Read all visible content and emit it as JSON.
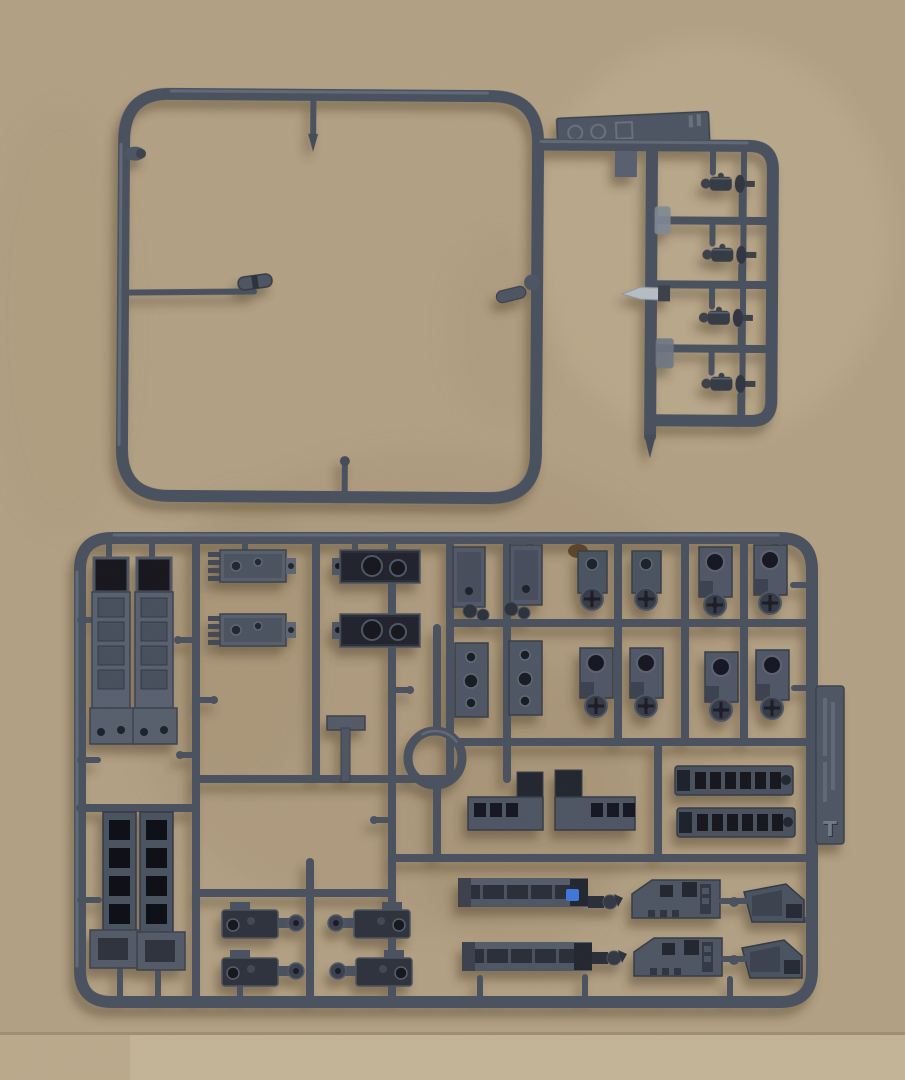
{
  "photo": {
    "description": "Top-down photograph of two dark gunmetal-gray injection-molded plastic model kit sprues (part runners) lying on a tan cardboard sheet with water stains and a lighter seam strip along the bottom edge."
  },
  "colors": {
    "cardboard": "#b3a185",
    "cardboard_light_strip": "#c4b496",
    "cardboard_stain": "#9b886a",
    "plastic_runner": "#49515f",
    "plastic_highlight": "#68727f",
    "plastic_dark": "#2a2e38",
    "plastic_recess": "#14171d",
    "bare_metal_blade": "#b6bdc5",
    "blue_paint_spot": "#3f76db",
    "scuff_brown": "#54391f"
  },
  "top_sprue": {
    "name": "square frame runner",
    "description": "Large empty rounded-square runner frame with a small ladder section on the right holding four tiny detail parts and one bayonet-blade part",
    "tag": {
      "marks": [
        "recycle-circle-symbol",
        "recycle-circle-symbol",
        "material-square-symbol",
        "mold-tick-marks"
      ]
    },
    "parts": [
      {
        "name": "tiny figure fitting part",
        "count": 4
      },
      {
        "name": "bayonet blade part",
        "count": 1
      },
      {
        "name": "clip part on inner rod",
        "count": 1
      },
      {
        "name": "clip part on right edge",
        "count": 1
      }
    ]
  },
  "bottom_sprue": {
    "name": "rectangular parts runner",
    "description": "Densely packed runner with hull, chassis and running-gear parts for a military vehicle model kit",
    "tag_letter": "T",
    "embossed_text_note": "illegible embossed lettering on side tag above the letter T",
    "parts": [
      {
        "name": "hull side channel",
        "count": 2
      },
      {
        "name": "ribbed deck plate",
        "count": 2
      },
      {
        "name": "dark twin-hole plate",
        "count": 2
      },
      {
        "name": "small vertical plate",
        "count": 2
      },
      {
        "name": "multi-hole side plate",
        "count": 2
      },
      {
        "name": "axle mount with sprocket wheel",
        "count": 8
      },
      {
        "name": "T-shaped bracket",
        "count": 1
      },
      {
        "name": "ring race part",
        "count": 1
      },
      {
        "name": "stepped window bracket mirrored pair",
        "count": 2
      },
      {
        "name": "slotted roof bar",
        "count": 2
      },
      {
        "name": "track ladder section",
        "count": 2
      },
      {
        "name": "gearbox housing",
        "count": 4
      },
      {
        "name": "chassis rail",
        "count": 2
      },
      {
        "name": "notched hull block",
        "count": 2
      },
      {
        "name": "angled hull wedge",
        "count": 2
      }
    ],
    "blue_paint_spot": "small blue mark on upper chassis rail"
  }
}
